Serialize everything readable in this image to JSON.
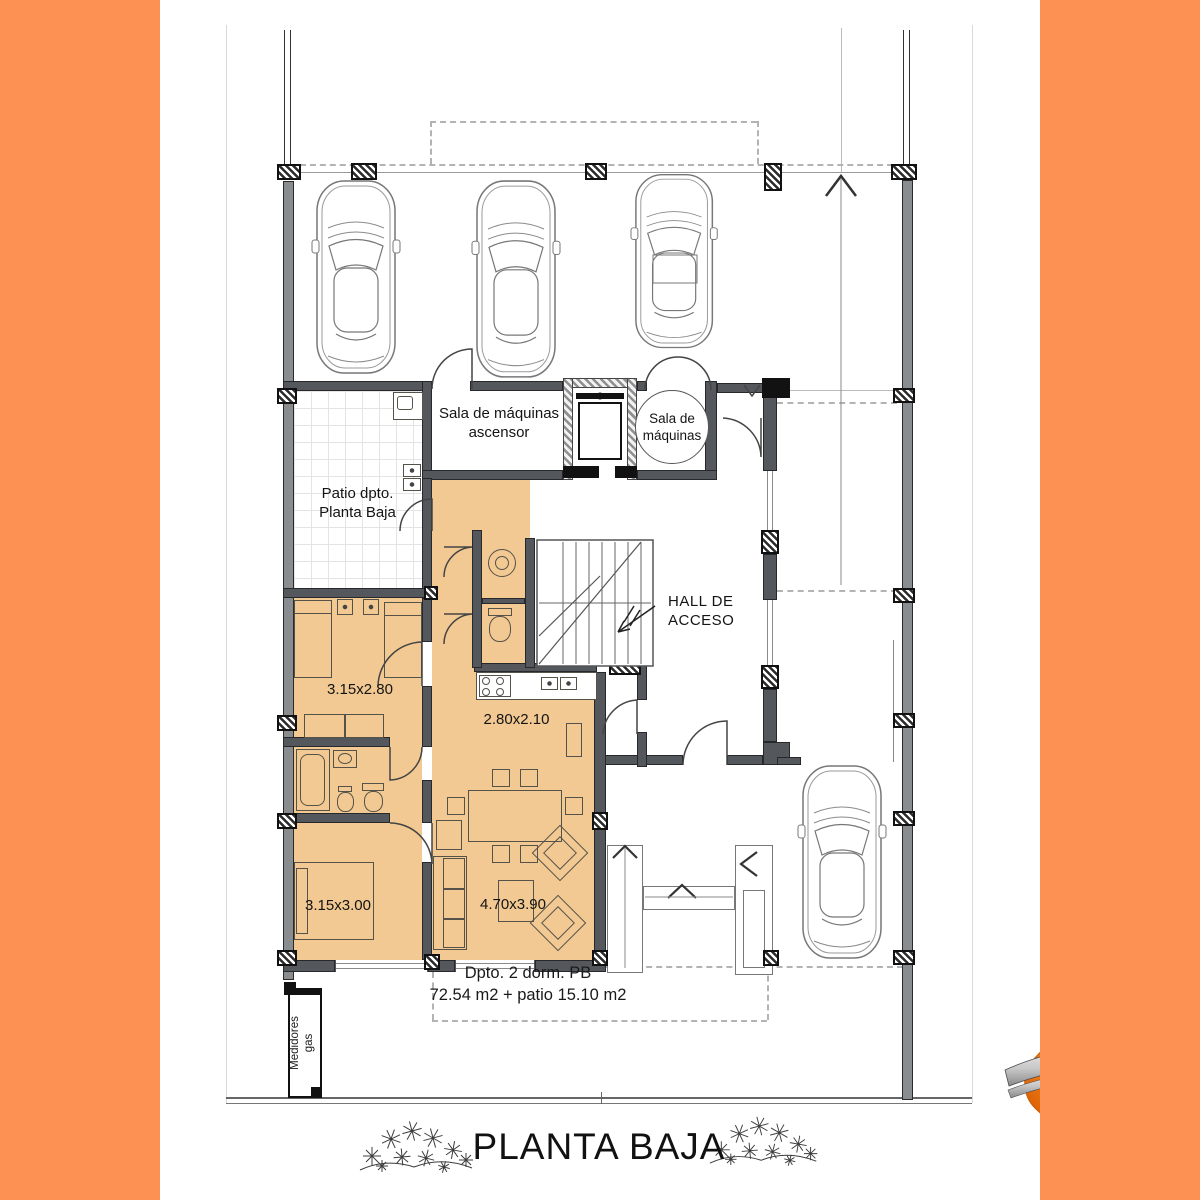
{
  "colors": {
    "accent_orange": "#FC9153",
    "room_fill": "#F2C992",
    "wall_gray": "#54575C"
  },
  "plan": {
    "rooms": {
      "machine_room_elevator": {
        "line1": "Sala de máquinas",
        "line2": "ascensor"
      },
      "machine_room": {
        "line1": "Sala de",
        "line2": "máquinas"
      },
      "patio": {
        "line1": "Patio dpto.",
        "line2": "Planta Baja"
      },
      "hall": {
        "line1": "HALL DE",
        "line2": "ACCESO"
      },
      "gas_meters": {
        "line1": "Medidores",
        "line2": "gas"
      }
    },
    "dimensions": {
      "bedroom1": "3.15x2.80",
      "kitchen": "2.80x2.10",
      "bedroom2": "3.15x3.00",
      "living": "4.70x3.90"
    },
    "summary": {
      "line1": "Dpto. 2 dorm. PB",
      "line2": "72.54 m2 + patio 15.10 m2"
    }
  },
  "footer": {
    "title": "PLANTA BAJA"
  }
}
